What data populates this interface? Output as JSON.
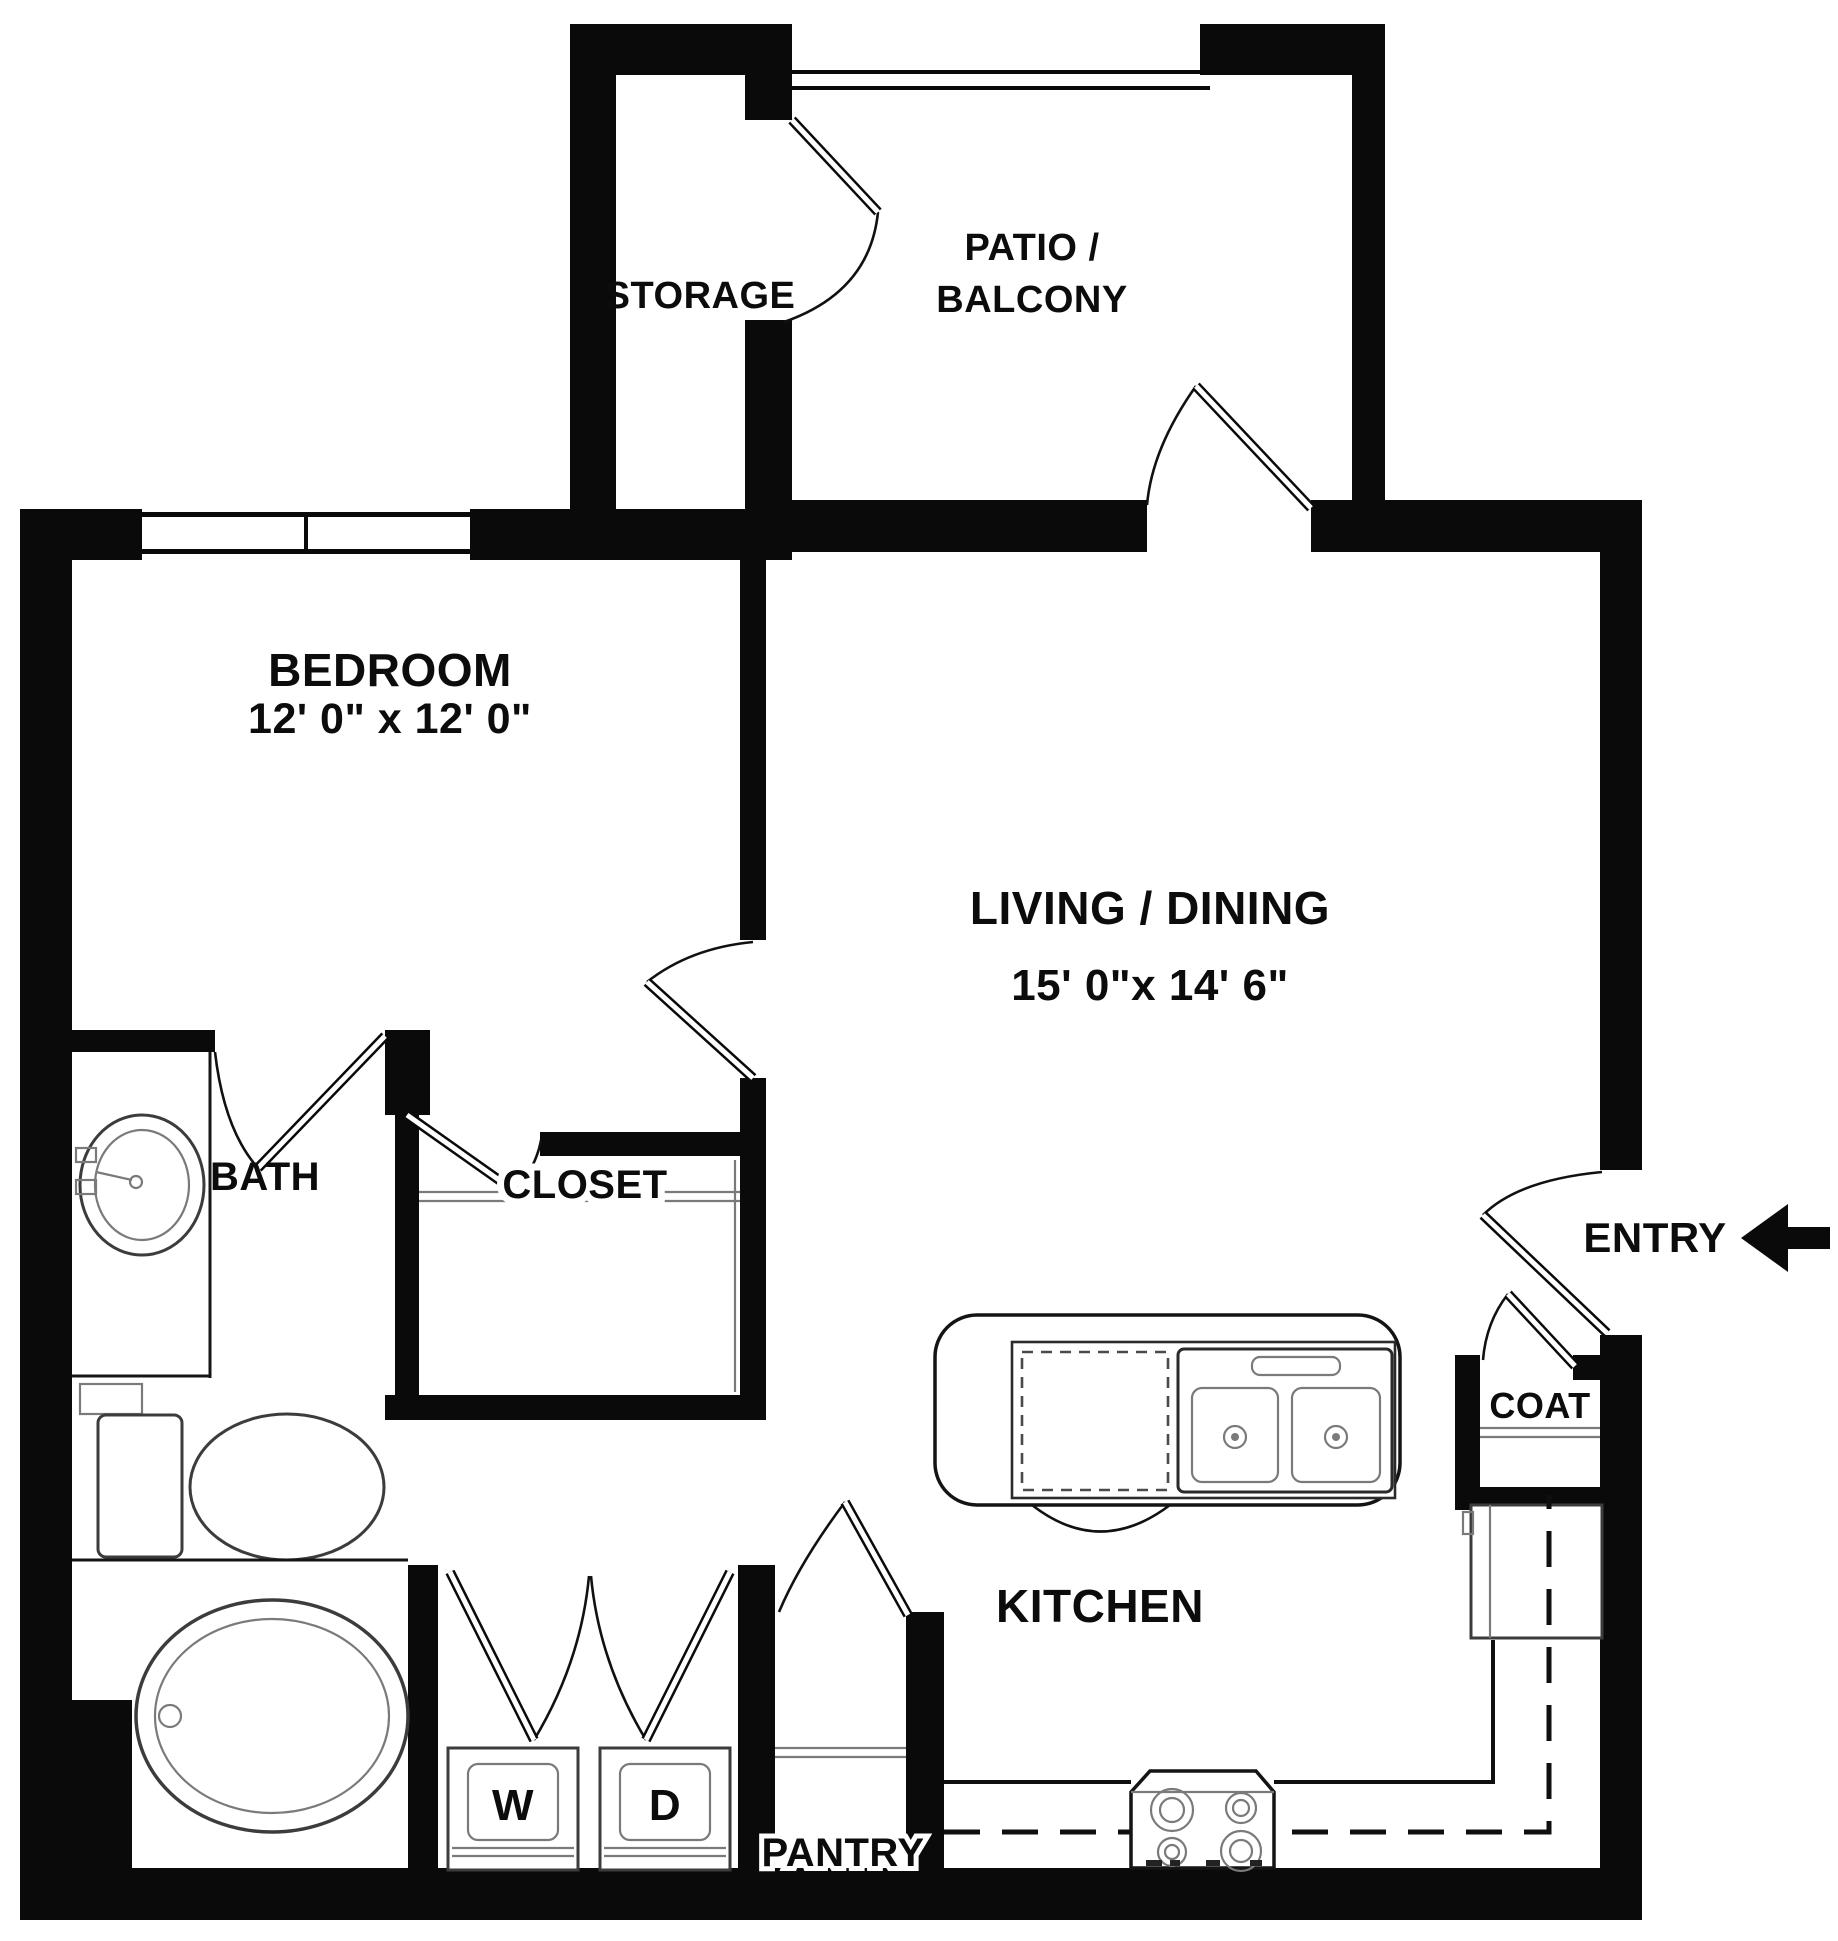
{
  "floor_plan": {
    "rooms": {
      "storage": {
        "label": "STORAGE"
      },
      "patio": {
        "label_line1": "PATIO /",
        "label_line2": "BALCONY"
      },
      "bedroom": {
        "label": "BEDROOM",
        "dimensions": "12' 0\" x 12' 0\""
      },
      "living_dining": {
        "label": "LIVING / DINING",
        "dimensions": "15' 0\"x 14' 6\""
      },
      "bath": {
        "label": "BATH"
      },
      "closet": {
        "label": "CLOSET"
      },
      "coat": {
        "label": "COAT"
      },
      "kitchen": {
        "label": "KITCHEN"
      },
      "pantry": {
        "label": "PANTRY"
      }
    },
    "entry": {
      "label": "ENTRY",
      "arrow_icon": "left-arrow"
    },
    "appliances": {
      "washer_label": "W",
      "dryer_label": "D"
    },
    "colors": {
      "wall": "#0a0a0a",
      "background": "#ffffff",
      "fixture_line": "#3c3c3c"
    }
  }
}
